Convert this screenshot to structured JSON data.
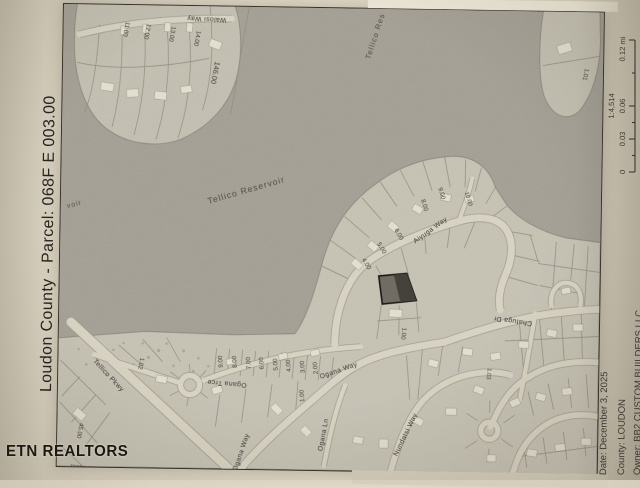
{
  "page": {
    "left_margin_title": "Loudon County - Parcel: 068F E 003.00",
    "watermark": "ETN REALTORS"
  },
  "scale_bar": {
    "ratio_label": "1:4,514",
    "tick_0": "0",
    "tick_003": "0.03",
    "tick_006": "0.06",
    "tick_012": "0.12 mi"
  },
  "map_info": {
    "date_line": "Date: December 3, 2025",
    "county_line": "County: LOUDON",
    "owner_line": "Owner: BB2 CUSTOM BUILDERS LLC"
  },
  "map": {
    "water_labels": {
      "reservoir_main": "Tellico Reservoir",
      "reservoir_top": "Tellico Res",
      "reservoir_left_fragment": "voir"
    },
    "street_labels": {
      "walosi_way": "Walosi Way",
      "tellico_pkwy": "Tellico Pkwy",
      "ogana_trce": "Ogana Trce",
      "ogana_way_upper": "Ogana Way",
      "ogana_way_lower": "Ogana Way",
      "ogana_ln": "Ogana Ln",
      "nundatsi_way": "Nundatsi Way",
      "aiyuga_way": "Aiyuga Way",
      "chatuga_dr": "Chatuga Dr"
    },
    "lot_labels": {
      "walosi_11": "11.00",
      "walosi_12": "12.00",
      "walosi_13": "13.00",
      "walosi_14": "14.00",
      "parcel_146": "146.00",
      "peninsula_1_01": "1.01",
      "aiyuga_4": "4.00",
      "aiyuga_5": "5.00",
      "aiyuga_6": "6.00",
      "aiyuga_8": "8.00",
      "aiyuga_9": "9.00",
      "aiyuga_10": "10.00",
      "subject_adjacent_1": "1.00",
      "ogana_row_9": "9.00",
      "ogana_row_8": "8.00",
      "ogana_row_7": "7.00",
      "ogana_row_6": "6.00",
      "ogana_row_5": "5.00",
      "ogana_row_4": "4.00",
      "ogana_row_3": "3.00",
      "ogana_row_2": "2.00",
      "ogana_1": "1.00",
      "ogana_1_02": "1.02",
      "lot_1_03": "1.03",
      "lot_45": "45.00",
      "lot_11011": "11011"
    },
    "colors": {
      "water": "#a4a095",
      "land": "#c6c2b4",
      "road": "#d9d3c2",
      "paper": "#ddd6c5",
      "highlight_parcel": "#5f5b52"
    }
  }
}
